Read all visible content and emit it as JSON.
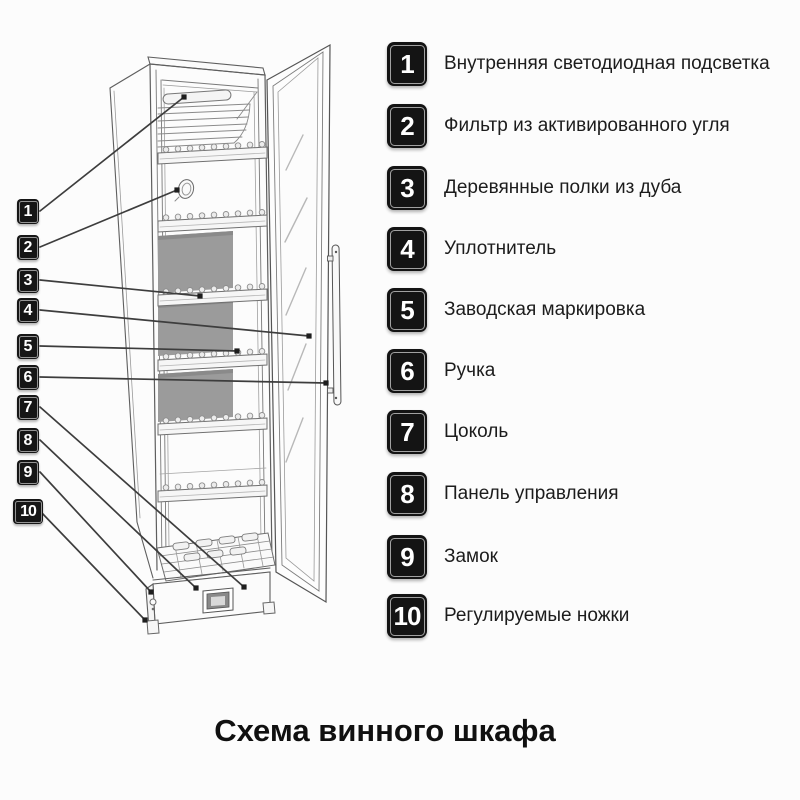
{
  "page": {
    "title": "Схема винного шкафа",
    "background": "#fcfcfc"
  },
  "legend": [
    {
      "num": "1",
      "label": "Внутренняя светодиодная подсветка"
    },
    {
      "num": "2",
      "label": "Фильтр из активированного угля"
    },
    {
      "num": "3",
      "label": "Деревянные полки из дуба"
    },
    {
      "num": "4",
      "label": "Уплотнитель"
    },
    {
      "num": "5",
      "label": "Заводская маркировка"
    },
    {
      "num": "6",
      "label": "Ручка"
    },
    {
      "num": "7",
      "label": "Цоколь"
    },
    {
      "num": "8",
      "label": "Панель управления"
    },
    {
      "num": "9",
      "label": "Замок"
    },
    {
      "num": "10",
      "label": "Регулируемые ножки"
    }
  ],
  "colors": {
    "badge_bg": "#141414",
    "badge_text": "#ffffff",
    "back_panel_gray": "#9b9b9b",
    "line_art": "#5e5e5e",
    "leader_line": "#3d3d3d",
    "text": "#1c1c1c"
  }
}
